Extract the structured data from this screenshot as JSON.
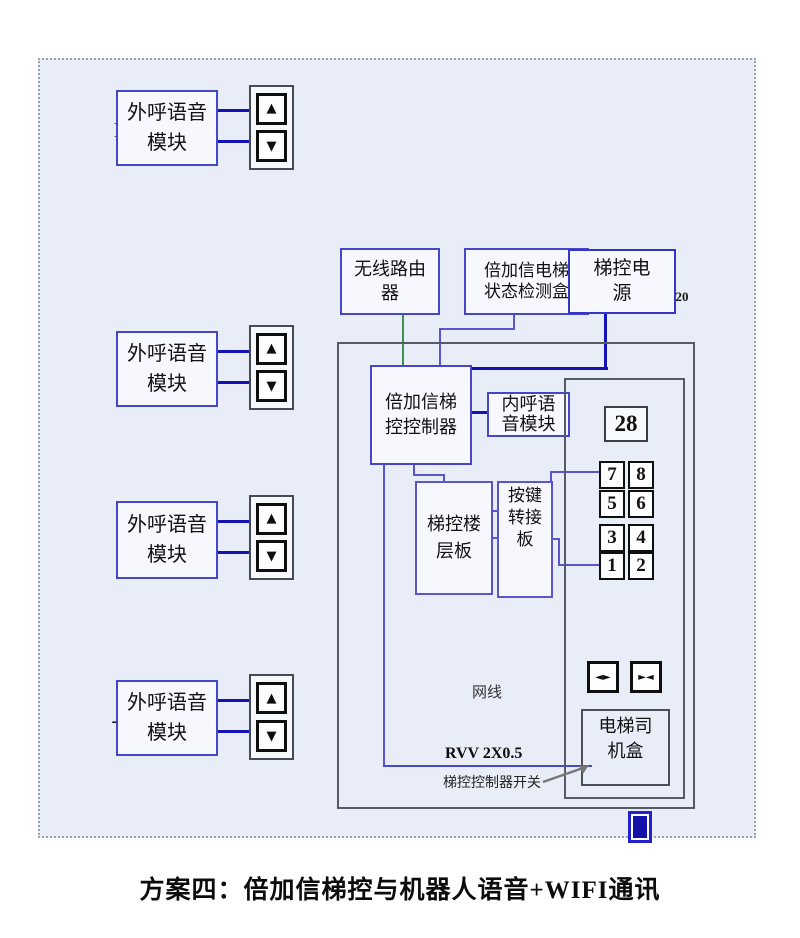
{
  "title": "放轿厢顶",
  "power_note": "电梯轿顶 ~220",
  "caption": "方案四：倍加信梯控与机器人语音+WIFI通讯",
  "floors": [
    {
      "label": "N楼",
      "module": "外呼语音模块"
    },
    {
      "label": "2楼",
      "module": "外呼语音模块"
    },
    {
      "label": "1楼",
      "module": "外呼语音模块"
    },
    {
      "label": "-1楼",
      "module": "外呼语音模块"
    }
  ],
  "boxes": {
    "router": "无线路由器",
    "detector": "倍加信电梯状态检测盒",
    "power": "梯控电源",
    "controller": "倍加信梯控控制器",
    "inner_call": "内呼语音模块",
    "floor_board": "梯控楼层板",
    "key_adapter": "按键转接板",
    "driver_box": "电梯司机盒"
  },
  "panel": {
    "display": "28",
    "keys": [
      "7",
      "8",
      "5",
      "6",
      "3",
      "4",
      "1",
      "2"
    ]
  },
  "labels": {
    "net_cable": "网线",
    "rvv": "RVV 2X0.5",
    "switch_label": "梯控控制器开关"
  },
  "icons": {
    "up": "▲",
    "down": "▼",
    "door_open": "◄►",
    "door_close": "►◄"
  },
  "colors": {
    "canvas_bg": "#e9edf8",
    "box_border_blue": "#4646c8",
    "enclosure_border": "#555a64",
    "wire_blue": "#1414b4",
    "wire_purple": "#5a55cc",
    "wire_green": "#3f8f55",
    "button_border": "#0e0e0e",
    "switch_blue": "#2222cc"
  }
}
